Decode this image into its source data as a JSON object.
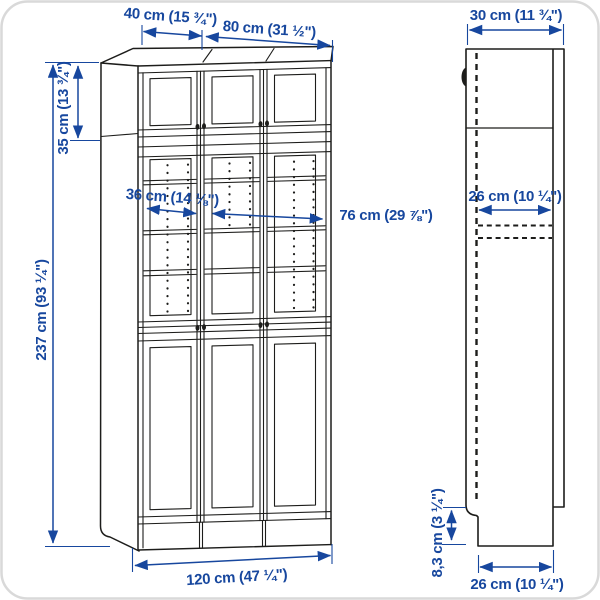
{
  "diagram": {
    "type": "furniture-dimension-diagram",
    "colors": {
      "dimension_blue": "#17479e",
      "outline_black": "#1d1d1b",
      "background": "#ffffff",
      "corner_frame_gray": "#d9d9d9"
    },
    "front_view": {
      "top_width_left": "40 cm (15 ¾\")",
      "top_width_right": "80 cm (31 ½\")",
      "extension_height": "35 cm (13 ¾\")",
      "total_height": "237 cm (93 ¼\")",
      "inner_width_single": "36 cm (14 ⅛\")",
      "inner_width_double": "76 cm (29 ⅞\")",
      "total_width": "120 cm (47 ¼\")"
    },
    "side_view": {
      "total_depth": "30 cm (11 ¾\")",
      "shelf_depth": "26 cm (10 ¼\")",
      "plinth_height": "8,3 cm (3 ¼\")",
      "base_depth": "26 cm (10 ¼\")"
    }
  }
}
